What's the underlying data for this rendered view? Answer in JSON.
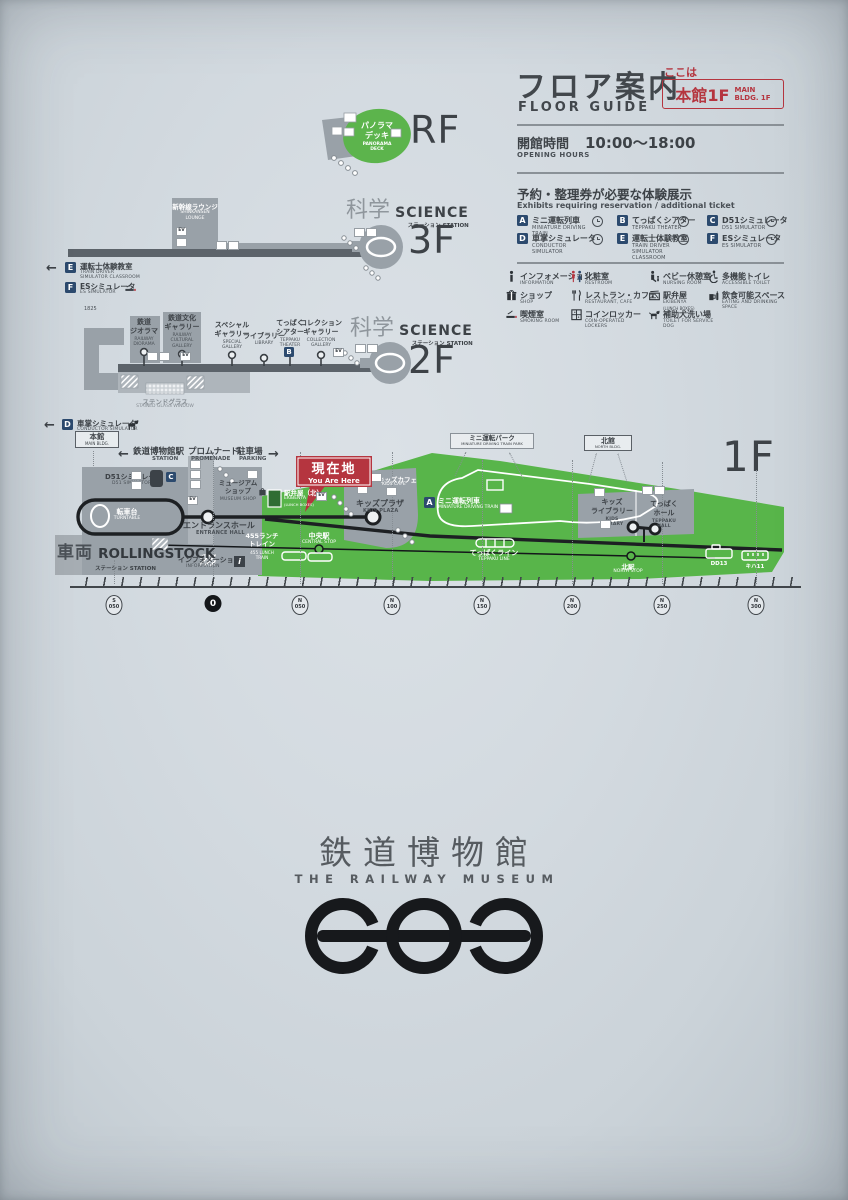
{
  "header": {
    "title_jp": "フロア案内",
    "title_en": "FLOOR GUIDE",
    "here_label": "ここは",
    "here_floor": "本館1F",
    "here_floor_en": "MAIN\nBLDG. 1F",
    "hours_label_jp": "開館時間",
    "hours_label_en": "OPENING HOURS",
    "hours_value": "10:00〜18:00"
  },
  "reservation": {
    "title_jp": "予約・整理券が必要な体験展示",
    "title_en": "Exhibits requiring reservation / additional ticket",
    "items": [
      {
        "letter": "A",
        "jp": "ミニ運転列車",
        "en": "MINIATURE DRIVING TRAIN"
      },
      {
        "letter": "B",
        "jp": "てっぱくシアター",
        "en": "TEPPAKU THEATER"
      },
      {
        "letter": "C",
        "jp": "D51シミュレータ",
        "en": "D51 SIMULATOR"
      },
      {
        "letter": "D",
        "jp": "車掌シミュレータ",
        "en": "CONDUCTOR SIMULATOR"
      },
      {
        "letter": "E",
        "jp": "運転士体験教室",
        "en": "TRAIN DRIVER\nSIMULATOR CLASSROOM"
      },
      {
        "letter": "F",
        "jp": "ESシミュレータ",
        "en": "ES SIMULATOR"
      }
    ]
  },
  "facilities": [
    {
      "jp": "インフォメーション",
      "en": "INFORMATION"
    },
    {
      "jp": "化粧室",
      "en": "RESTROOM"
    },
    {
      "jp": "ベビー休憩室",
      "en": "NURSING ROOM"
    },
    {
      "jp": "多機能トイレ",
      "en": "ACCESSIBLE TOILET"
    },
    {
      "jp": "ショップ",
      "en": "SHOP"
    },
    {
      "jp": "レストラン・カフェ",
      "en": "RESTAURANT, CAFE"
    },
    {
      "jp": "駅弁屋",
      "en": "EKIBENYA",
      "note": "(LUNCH BOXES)"
    },
    {
      "jp": "飲食可能スペース",
      "en": "EATING AND DRINKING SPACE"
    },
    {
      "jp": "喫煙室",
      "en": "SMOKING ROOM"
    },
    {
      "jp": "コインロッカー",
      "en": "COIN-OPERATED LOCKERS"
    },
    {
      "jp": "補助犬洗い場",
      "en": "TOILET FOR SERVICE DOG"
    }
  ],
  "arrows": {
    "left": "←",
    "right": "→"
  },
  "icons": {
    "ev": "EV",
    "info_i": "i"
  },
  "floors": {
    "rf": {
      "label": "RF",
      "panorama_jp": "パノラマ\nデッキ",
      "panorama_en": "PANORAMA\nDECK"
    },
    "f3": {
      "label": "3F",
      "science_jp": "科学",
      "science_en": "SCIENCE",
      "station_jp": "ステーション",
      "station_en": "STATION",
      "lounge_jp": "新幹線ラウンジ",
      "lounge_en": "SHINKANSEN\nLOUNGE"
    },
    "side": {
      "e_letter": "E",
      "e_jp": "運転士体験教室",
      "e_en": "TRAIN DRIVER\nSIMULATOR CLASSROOM",
      "f_letter": "F",
      "f_jp": "ESシミュレータ",
      "f_en": "ES SIMULATOR",
      "d_letter": "D",
      "d_jp": "車掌シミュレータ",
      "d_en": "CONDUCTOR SIMULATOR"
    },
    "f2": {
      "label": "2F",
      "science_jp": "科学",
      "science_en": "SCIENCE",
      "station_jp": "ステーション",
      "station_en": "STATION",
      "measure": "1825",
      "rooms": [
        {
          "jp": "鉄道\nジオラマ",
          "en": "RAILWAY\nDIORAMA"
        },
        {
          "jp": "鉄道文化\nギャラリー",
          "en": "RAILWAY\nCULTURAL\nGALLERY"
        },
        {
          "jp": "スペシャル\nギャラリー",
          "en": "SPECIAL\nGALLERY"
        },
        {
          "jp": "ライブラリー",
          "en": "LIBRARY"
        },
        {
          "jp": "てっぱく\nシアター",
          "en": "TEPPAKU\nTHEATER",
          "badge": "B"
        },
        {
          "jp": "コレクション\nギャラリー",
          "en": "COLLECTION\nGALLERY"
        }
      ],
      "stained_glass_jp": "ステンドグラス",
      "stained_glass_en": "STAINED GLASS WINDOW"
    },
    "f1": {
      "label": "1F",
      "main_bldg_jp": "本館",
      "main_bldg_en": "MAIN BLDG.",
      "station_jp": "鉄道博物館駅",
      "station_en": "STATION",
      "promenade_jp": "プロムナード",
      "promenade_en": "PROMENADE",
      "parking_jp": "駐車場",
      "parking_en": "PARKING",
      "mini_park_jp": "ミニ運転パーク",
      "mini_park_en": "MINIATURE DRIVING TRAIN PARK",
      "north_bldg_jp": "北館",
      "north_bldg_en": "NORTH BLDG.",
      "d51_badge": "C",
      "d51_jp": "D51シミュレータ",
      "d51_en": "D51 SIMULATOR",
      "turntable_jp": "転車台",
      "turntable_en": "TURNTABLE",
      "museum_shop_jp": "ミュージアム\nショップ",
      "museum_shop_en": "MUSEUM SHOP",
      "entrance_jp": "エントランスホール",
      "entrance_en": "ENTRANCE HALL",
      "rolling_jp": "車両",
      "rolling_en": "ROLLINGSTOCK",
      "rolling_sub": "ステーション STATION",
      "info_jp": "インフォメーション",
      "info_en": "INFORMATION",
      "lunch_jp": "455ランチ\nトレイン",
      "lunch_en": "455 LUNCH\nTRAIN",
      "ekiben_jp": "駅弁屋（北）",
      "ekiben_en": "EKIBENYA",
      "ekiben_note": "(LUNCH BOXES)",
      "here_jp": "現在地",
      "here_en": "You Are Here",
      "kids_cafe_jp": "キッズカフェ",
      "kids_cafe_en": "KIDS CAFE",
      "kids_plaza_jp": "キッズプラザ",
      "kids_plaza_en": "KIDS PLAZA",
      "mini_train_badge": "A",
      "mini_train_jp": "ミニ運転列車",
      "mini_train_en": "MINIATURE DRIVING TRAIN",
      "central_jp": "中央駅",
      "central_en": "CENTRAL STOP",
      "line_jp": "てっぱくライン",
      "line_en": "TEPPAKU LINE",
      "kids_lib_jp": "キッズ\nライブラリー",
      "kids_lib_en": "KIDS\nLIBRARY",
      "hall_jp": "てっぱく\nホール",
      "hall_en": "TEPPAKU\nHALL",
      "north_stop_jp": "北駅",
      "north_stop_en": "NORTH STOP",
      "dd13": "DD13",
      "kiha11": "キハ11"
    }
  },
  "ruler": {
    "marks": [
      {
        "top": "S",
        "bottom": "050"
      },
      {
        "top": "",
        "bottom": "0"
      },
      {
        "top": "N",
        "bottom": "050"
      },
      {
        "top": "N",
        "bottom": "100"
      },
      {
        "top": "N",
        "bottom": "150"
      },
      {
        "top": "N",
        "bottom": "200"
      },
      {
        "top": "N",
        "bottom": "250"
      },
      {
        "top": "N",
        "bottom": "300"
      }
    ]
  },
  "logo": {
    "jp": "鉄道博物館",
    "en": "THE RAILWAY MUSEUM"
  },
  "colors": {
    "accent_red": "#b5353f",
    "badge_navy": "#2c4a6e",
    "map_green": "#58b54a",
    "map_gray": "#99a1a8"
  }
}
